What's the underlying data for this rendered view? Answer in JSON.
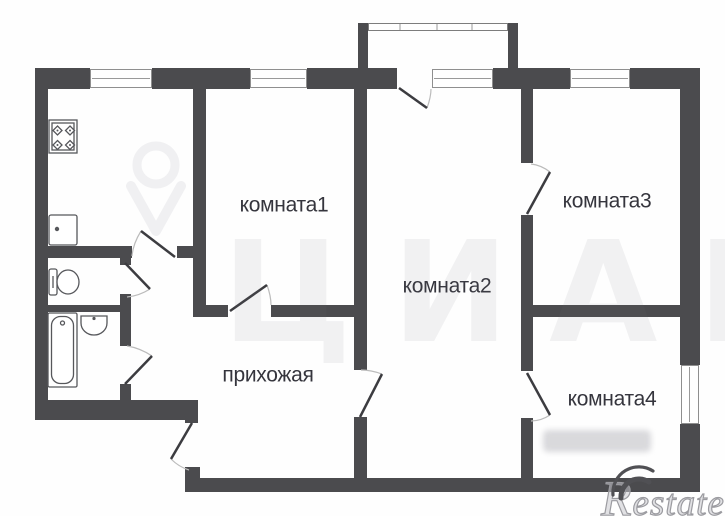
{
  "plan": {
    "rooms": [
      {
        "id": "room1",
        "label": "комната1"
      },
      {
        "id": "room2",
        "label": "комната2"
      },
      {
        "id": "room3",
        "label": "комната3"
      },
      {
        "id": "room4",
        "label": "комната4"
      },
      {
        "id": "hallway",
        "label": "прихожая"
      }
    ],
    "fixtures": [
      "stove-icon",
      "kitchen-sink-icon",
      "toilet-icon",
      "bathtub-icon",
      "washbasin-icon"
    ]
  },
  "watermarks": {
    "center_logo_text": "ЦИАН",
    "corner_logo_text": "Restate"
  },
  "colors": {
    "wall": "#4b4b4e",
    "label_text": "#35353d",
    "door_line": "#3c3c40",
    "arc_line": "#bbbbbb",
    "window_frame": "#8f8f8f",
    "watermark_gray": "#ededef",
    "restate_gray": "#9b9ba0",
    "background": "#ffffff"
  }
}
